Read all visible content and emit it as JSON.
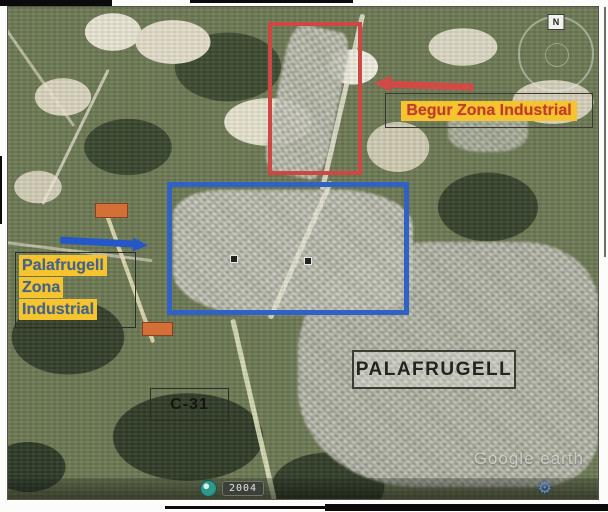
{
  "map": {
    "compass_label": "N",
    "watermark": "Google earth",
    "status": {
      "year": "2004"
    }
  },
  "icons": {
    "gear": "⚙"
  },
  "annotations": {
    "begur_zone": {
      "label": "Begur Zona Industrial",
      "text_color": "#c43a2e",
      "highlight_color": "#f6c42e",
      "outline_color": "#cf4743",
      "arrow_color": "#d14a46"
    },
    "palafrugell_zone": {
      "line1": "Palafrugell",
      "line2": "Zona",
      "line3": "Industrial",
      "text_color": "#40648f",
      "highlight_color": "#f6c42e",
      "outline_color": "#2f62c4",
      "arrow_color": "#2458c8"
    },
    "city_label": "PALAFRUGELL",
    "road_label": "C-31",
    "road_marker_color": "#d46f38"
  }
}
